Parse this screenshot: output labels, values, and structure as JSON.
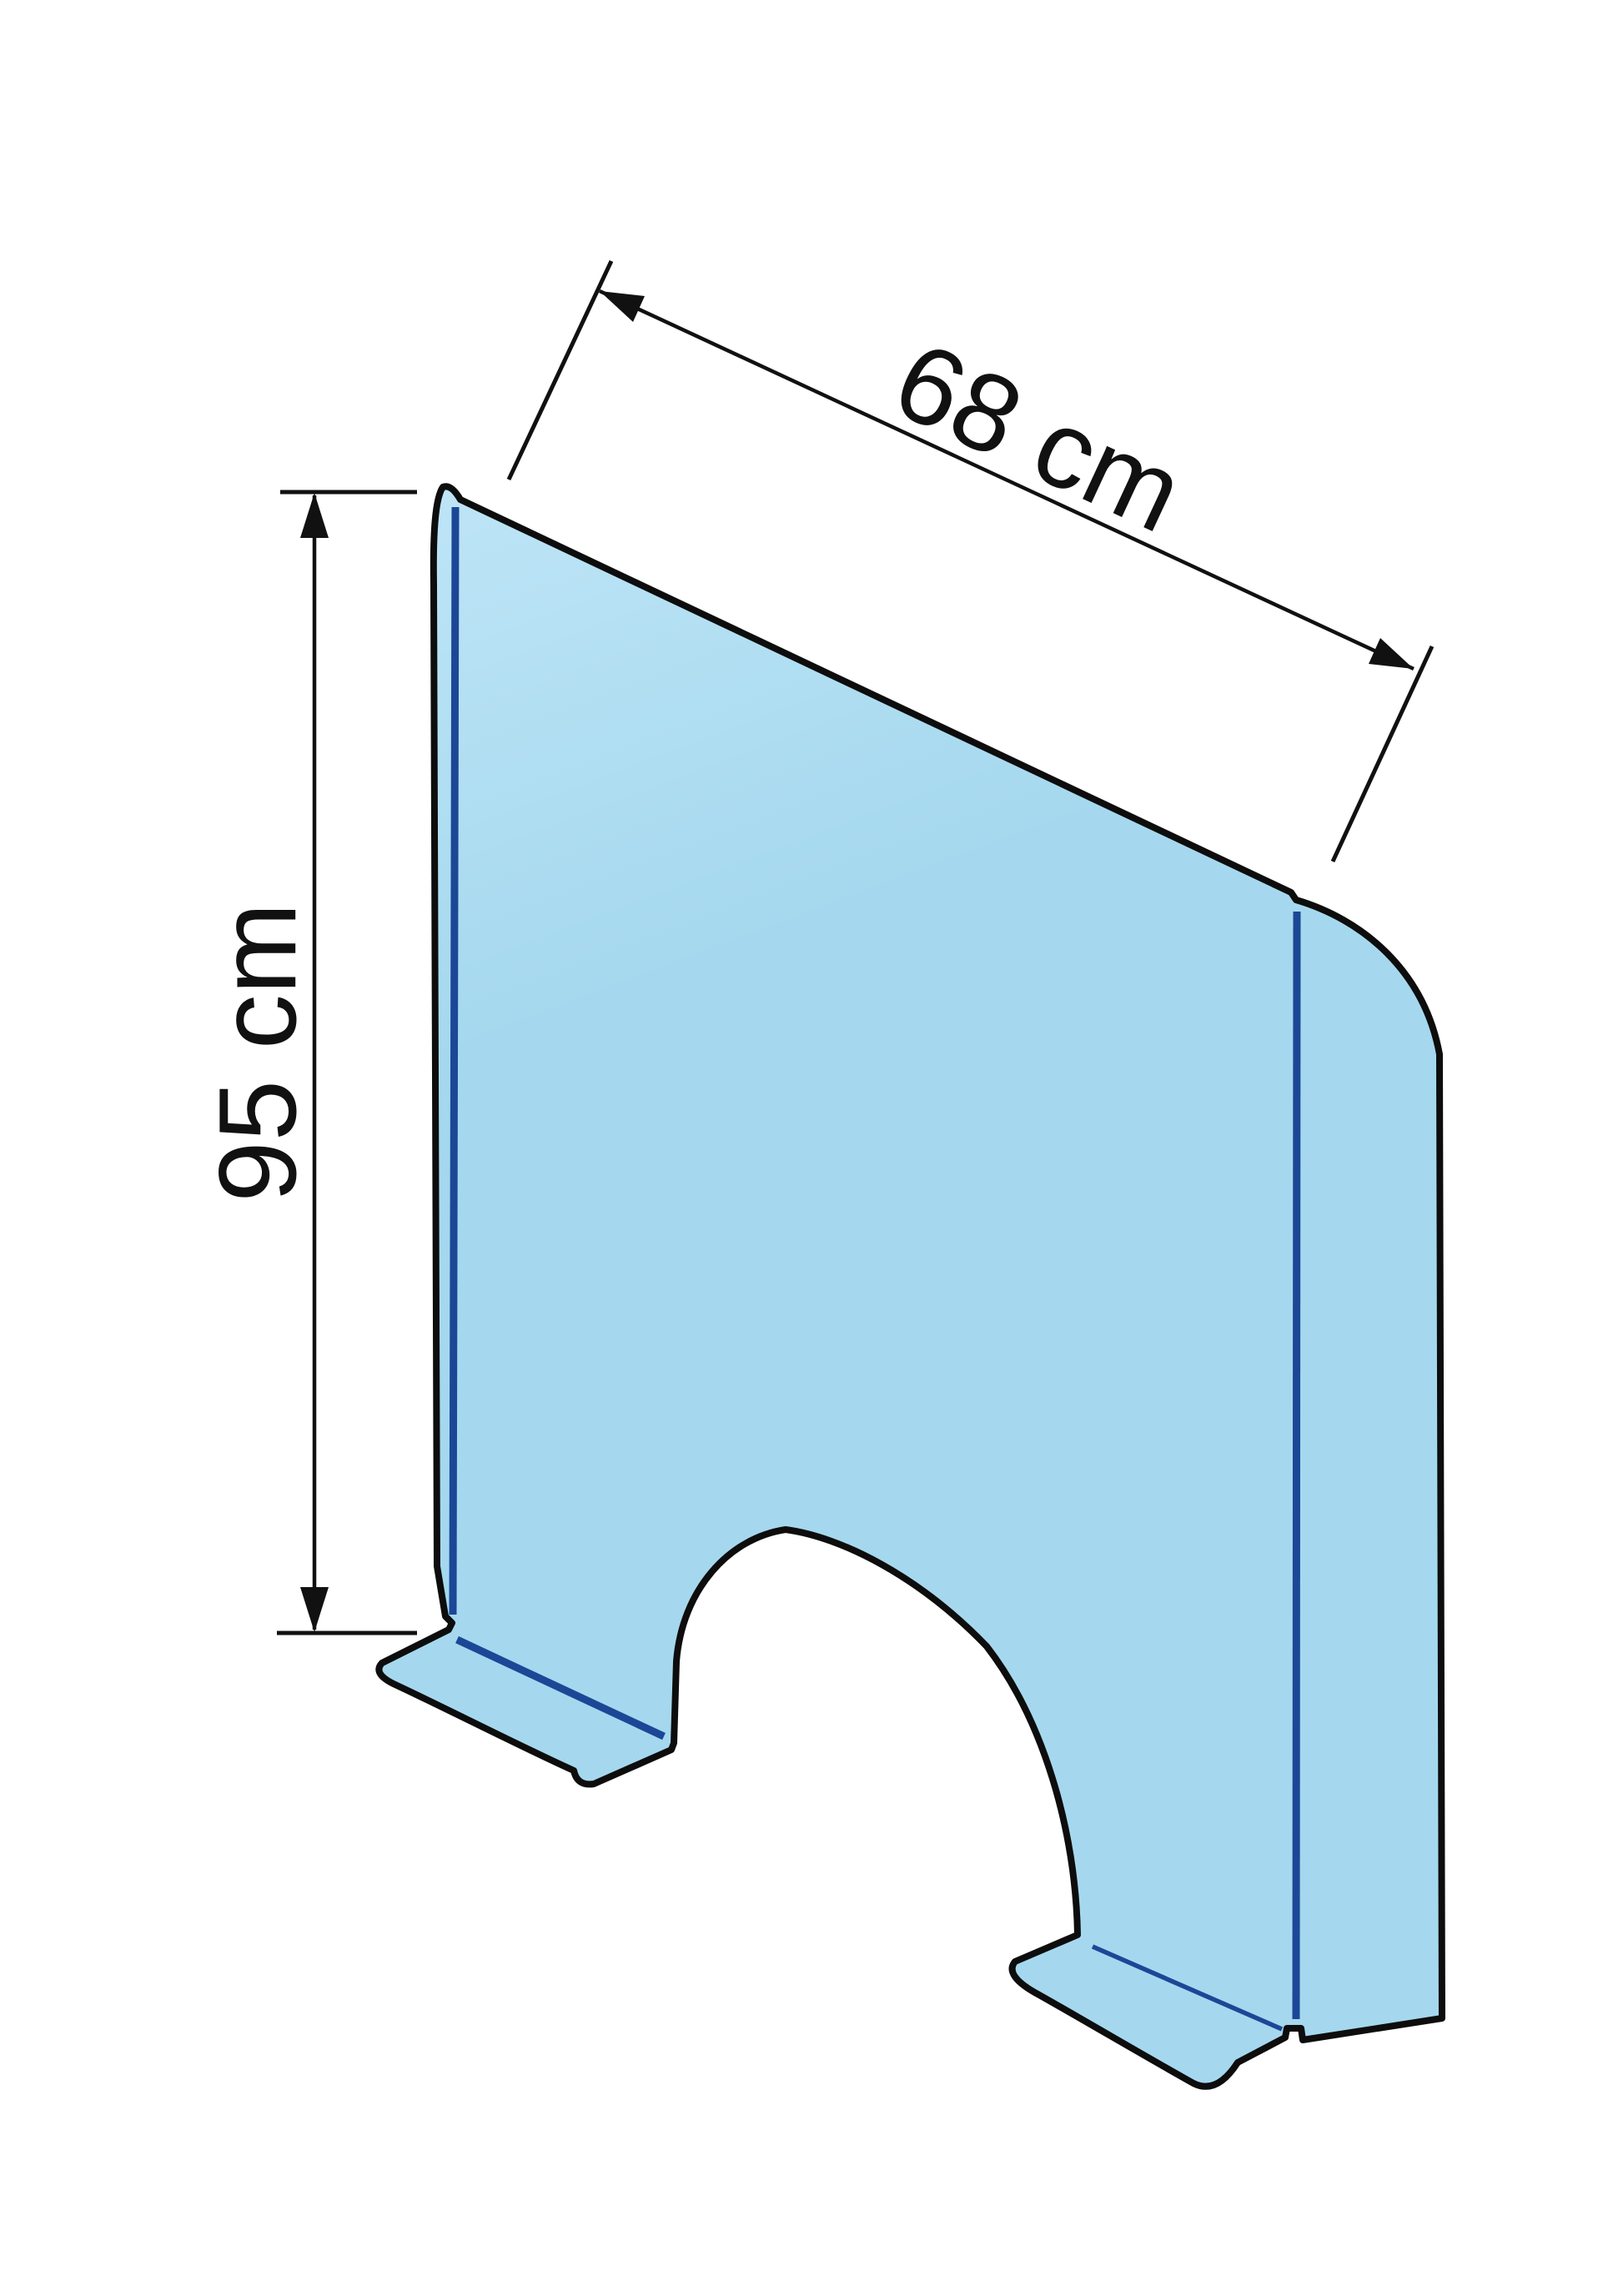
{
  "diagram": {
    "subject": "folded transparent protective counter screen with arch pass-through cutout and fold-out feet",
    "labels": {
      "width_label": "68 cm",
      "height_label": "95 cm"
    },
    "dimensions": {
      "width_cm": 68,
      "height_cm": 95
    }
  },
  "colors": {
    "background": "#ffffff",
    "panel_fill": "#a5d8ee",
    "panel_fill_light": "#bfe5f7",
    "fold_line": "#1c4796",
    "outline": "#0d0d0d",
    "dimension": "#111111"
  }
}
